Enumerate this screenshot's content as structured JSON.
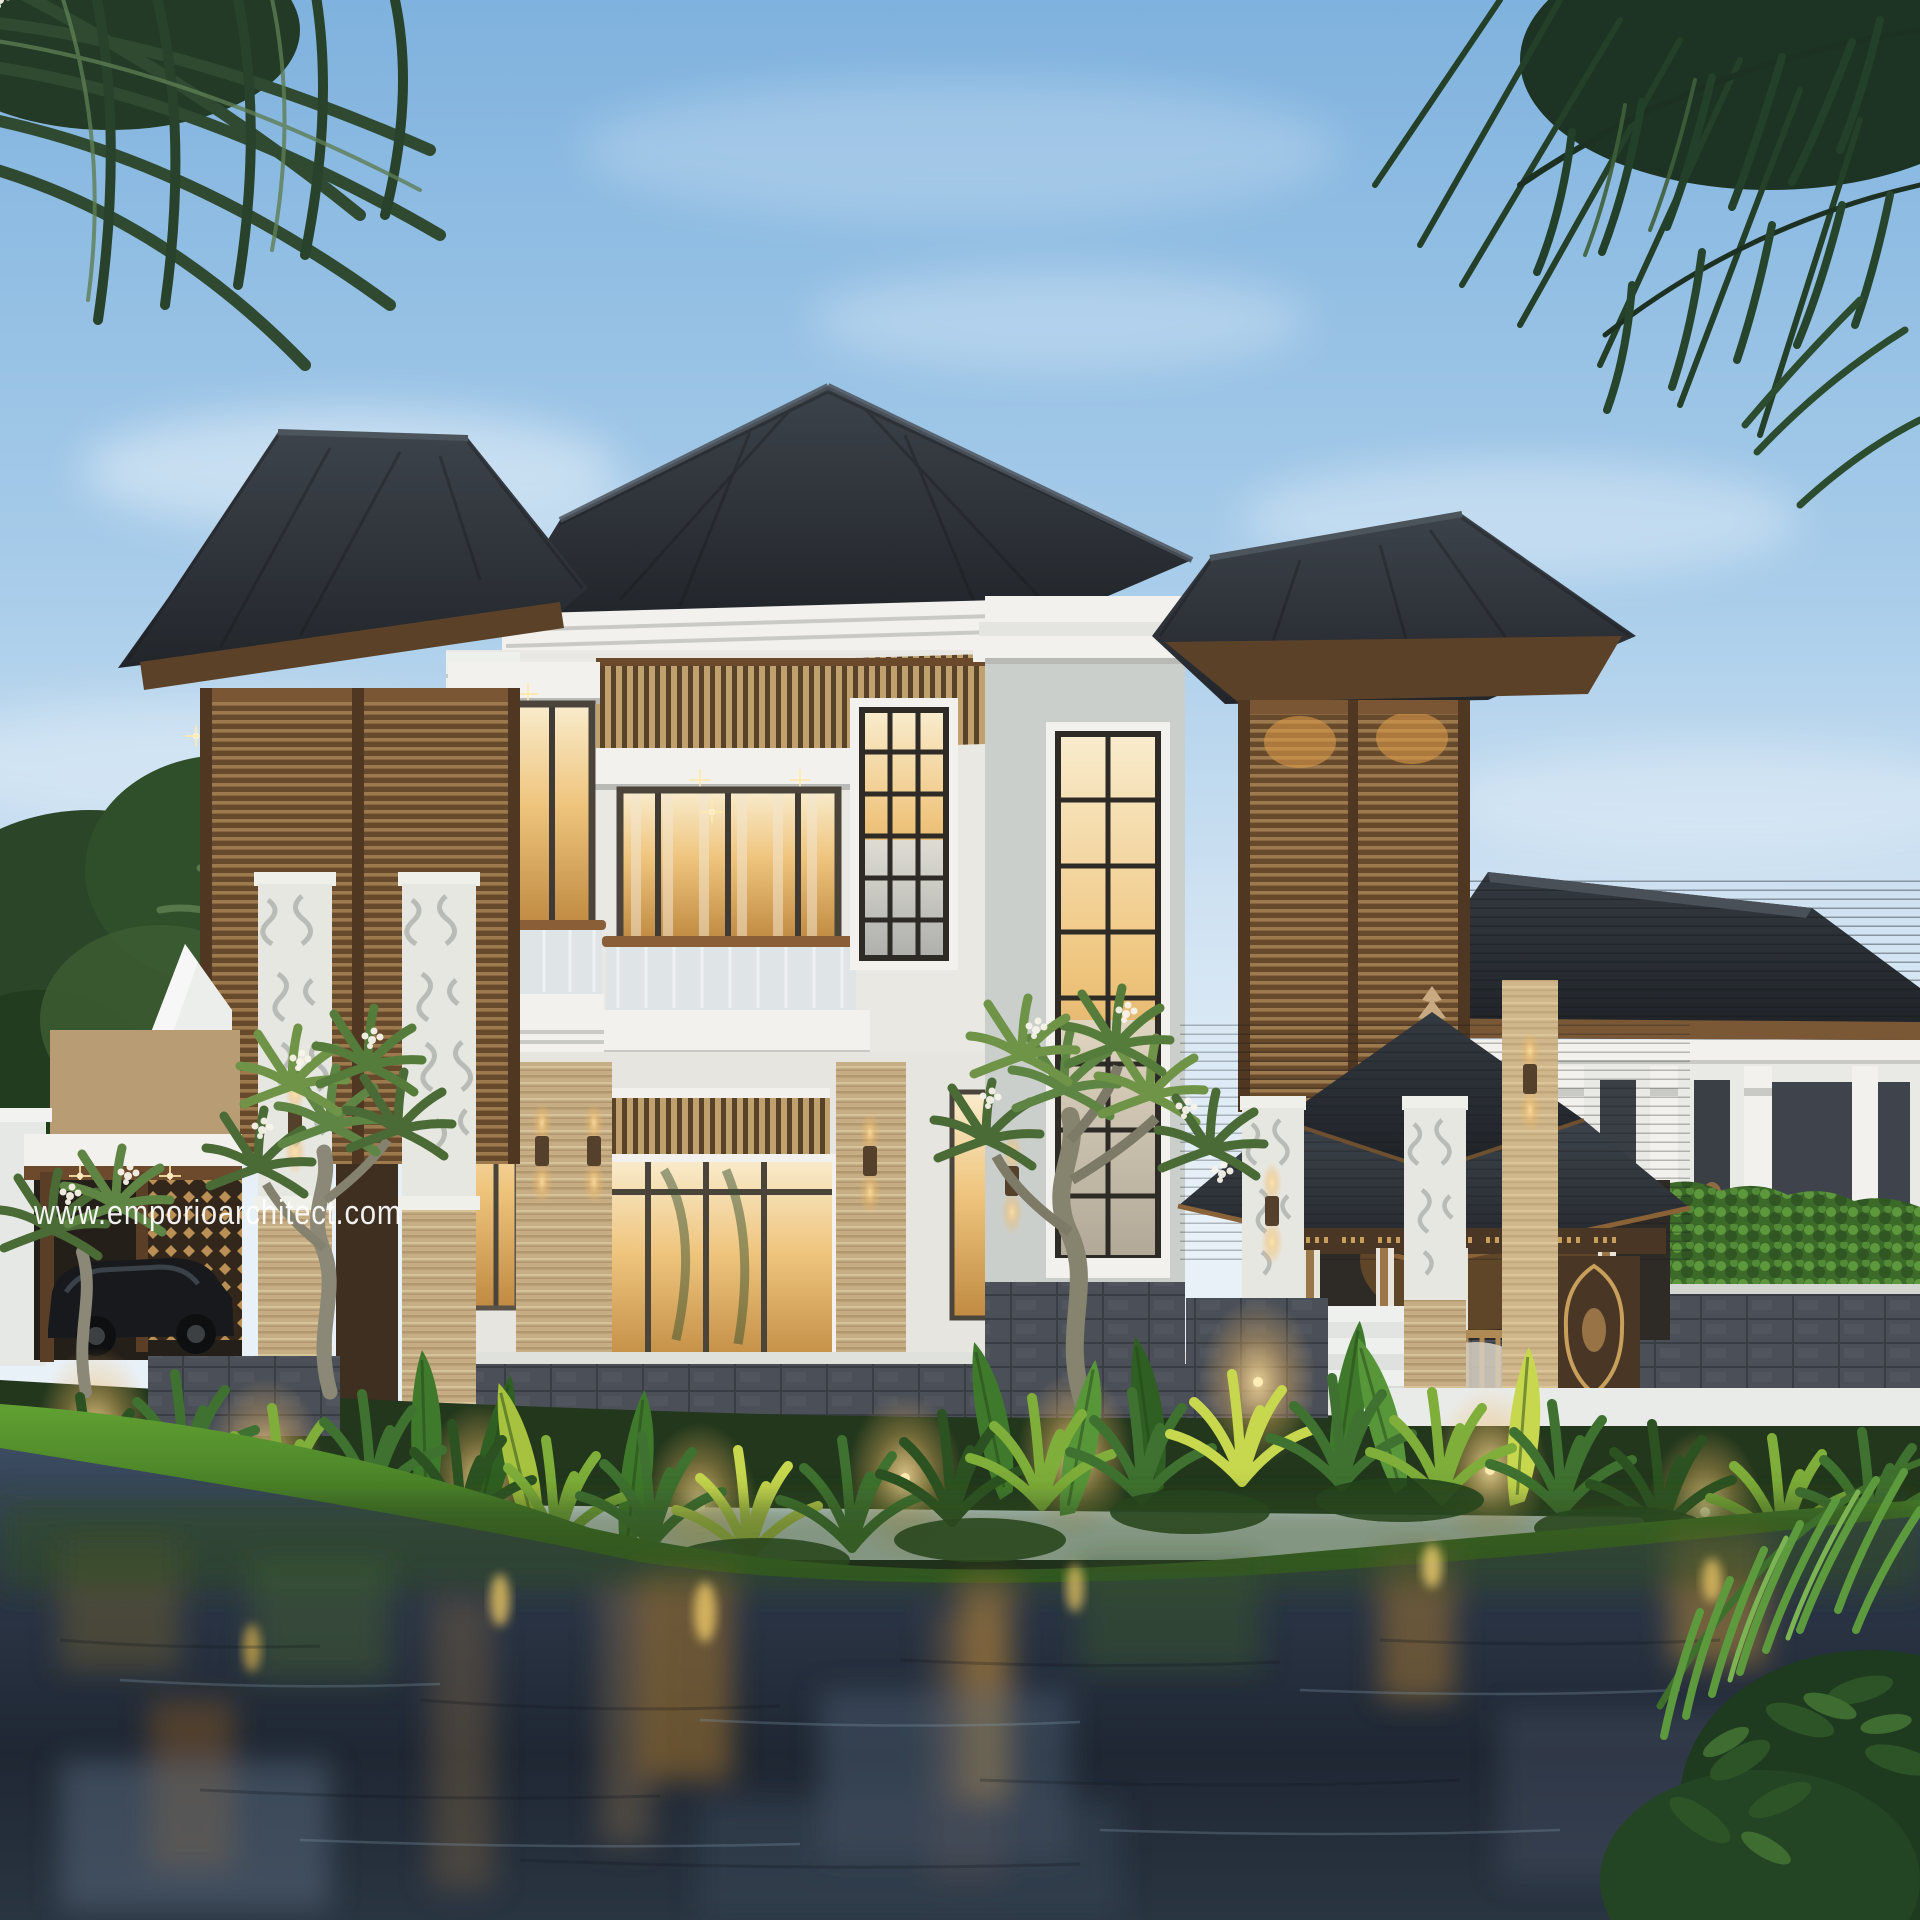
{
  "image_type": "architectural-exterior-render",
  "watermark": {
    "text": "www.emporioarchitect.com",
    "color": "#ffffff"
  },
  "palette": {
    "sky_top": "#7fb2de",
    "sky_mid": "#a9cdea",
    "sky_horizon": "#e9f1f8",
    "cloud_white": "#ffffff",
    "palm_dark": "#22391f",
    "palm_mid": "#3a5c38",
    "palm_bright": "#5f9a40",
    "foliage_dark": "#2c5222",
    "foliage_mid": "#3f7230",
    "foliage_lit": "#7fae3a",
    "foliage_bright": "#c8d84e",
    "roof_dark": "#22262b",
    "roof_light": "#3d434b",
    "wood_soffit": "#5c4129",
    "wood_slat": "#9c7a4e",
    "wood_slat_light": "#c0a06c",
    "wood_frame": "#6b4a2c",
    "white_wall": "#f2f1ed",
    "white_trim_shadow": "#c9cac6",
    "travertine": "#c6ad84",
    "travertine_dark": "#a88d63",
    "carved_stone": "#e7e7e1",
    "grey_stone": "#cbcfcc",
    "basalt_base": "#4b5058",
    "glass_warm_top": "#f9eccd",
    "glass_warm_deep": "#c08a41",
    "glow_warm": "#ffdf9e",
    "hedge_green": "#57923b",
    "grass_light": "#61a132",
    "grass_dark": "#2f5c1d",
    "water_top": "#3c4c60",
    "water_deep": "#1f2733",
    "watermark_white": "#ffffff"
  }
}
